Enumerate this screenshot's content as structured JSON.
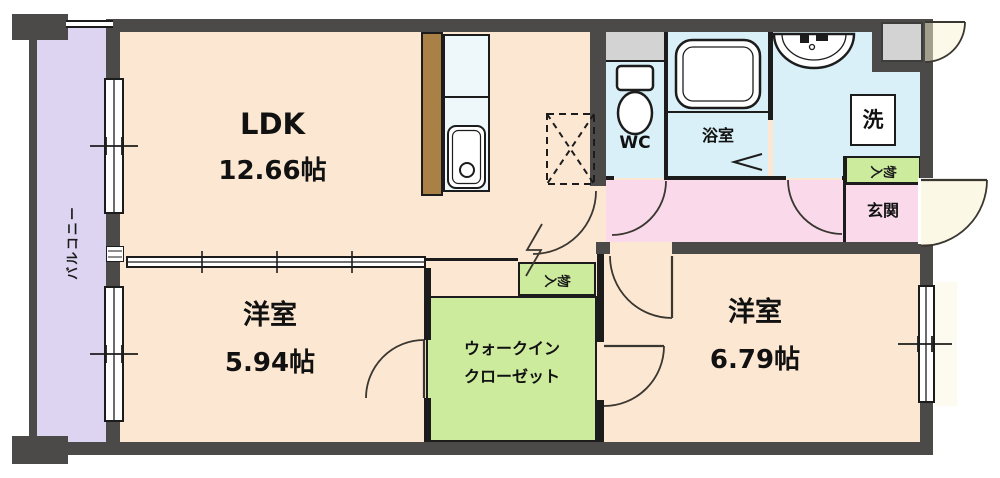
{
  "rooms": {
    "ldk": {
      "label": "LDK",
      "area": "12.66帖"
    },
    "western_room_small": {
      "label": "洋室",
      "area": "5.94帖"
    },
    "western_room_large": {
      "label": "洋室",
      "area": "6.79帖"
    },
    "walk_in_closet": {
      "line1": "ウォークイン",
      "line2": "クローゼット"
    },
    "toilet": {
      "label": "WC"
    },
    "bathroom": {
      "label": "浴室"
    },
    "laundry": {
      "label": "洗"
    },
    "entrance": {
      "label": "玄関"
    },
    "balcony": {
      "label": "バルコニー"
    },
    "hall_storage": {
      "label": "物入"
    },
    "closet_storage": {
      "label": "物入"
    }
  },
  "palette": {
    "wall": "#4b4a48",
    "line": "#1c1c1c",
    "room_peach": "#fce8d2",
    "balcony_purple": "#ddd4f2",
    "wet_blue": "#daf0f8",
    "hall_pink": "#f9d9ea",
    "closet_green": "#cdeb9d",
    "pipe_gray": "#d3d3d3",
    "counter_brown": "#a98147",
    "counter_top": "#eef8fb"
  }
}
